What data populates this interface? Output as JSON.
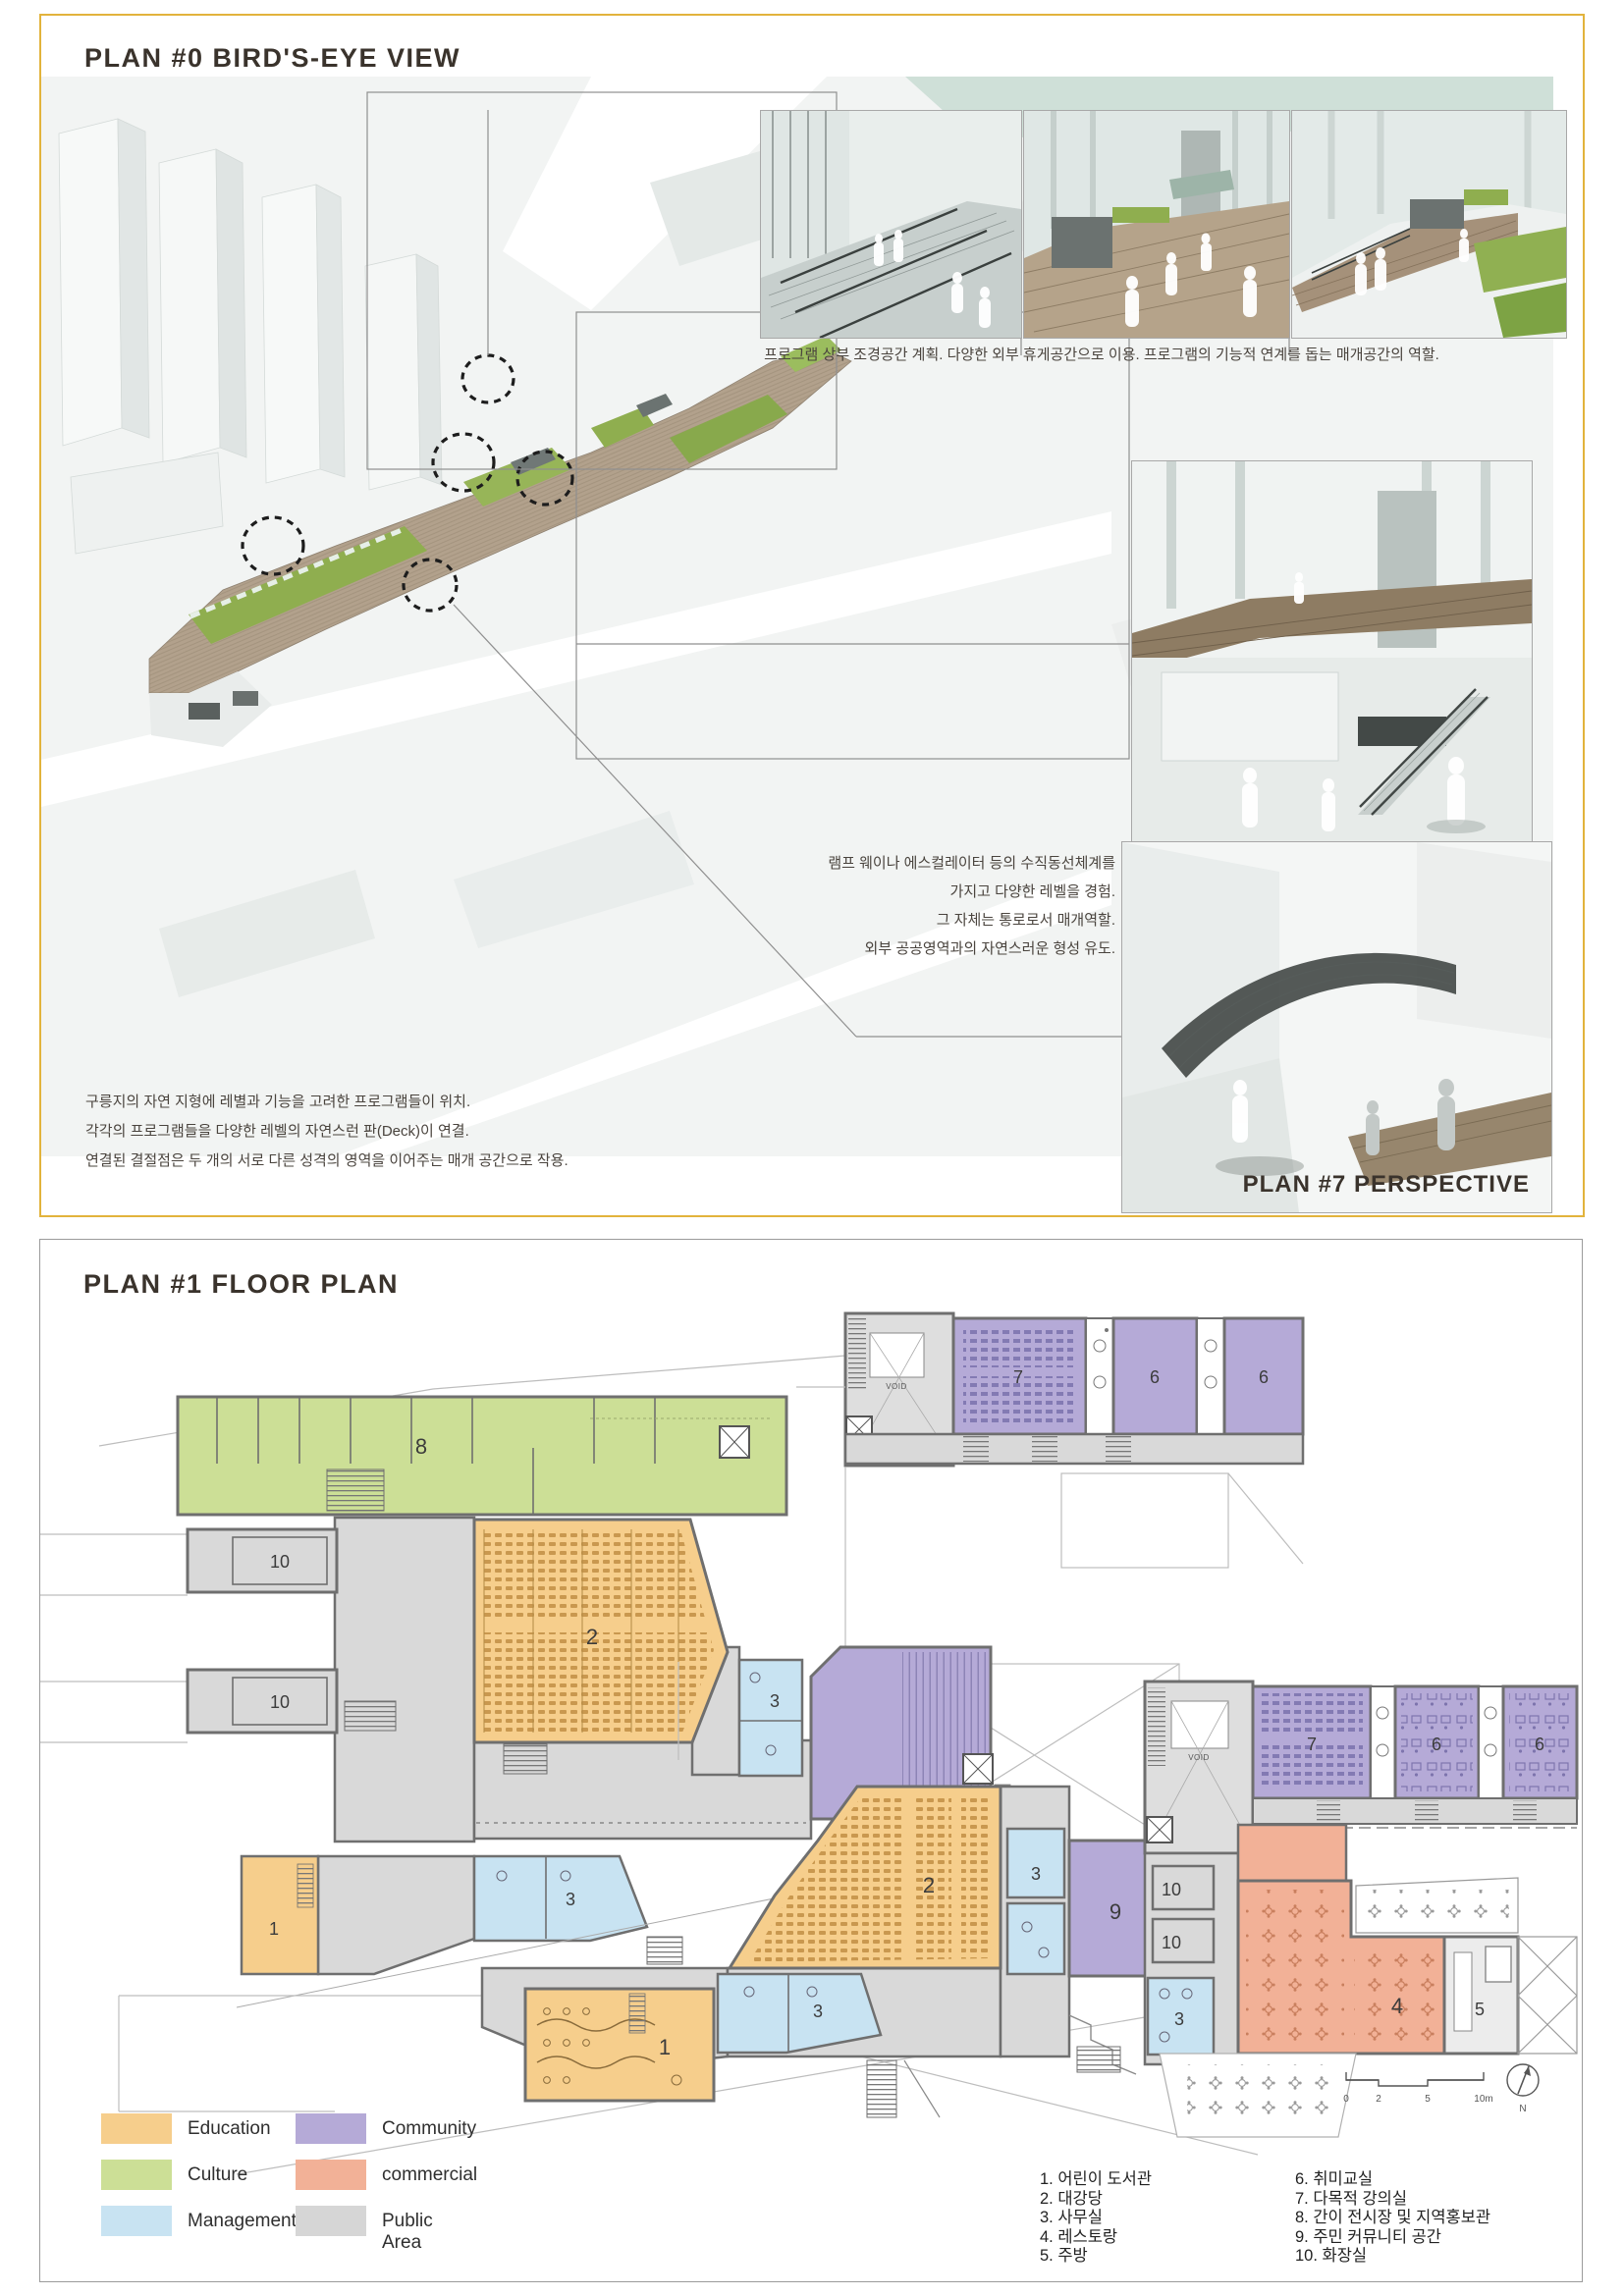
{
  "panel_top": {
    "title": "PLAN #0 BIRD'S-EYE VIEW",
    "insets_caption": "프로그램 상부 조경공간 계획. 다양한 외부 휴게공간으로 이용. 프로그램의 기능적 연계를 돕는 매개공간의 역할.",
    "annotation_vertical": {
      "line1": "램프 웨이나 에스컬레이터 등의 수직동선체계를",
      "line2": "가지고 다양한 레벨을 경험.",
      "line3": "그 자체는 통로로서 매개역할.",
      "line4": "외부 공공영역과의 자연스러운 형성 유도."
    },
    "annotation_site": {
      "line1": "구릉지의 자연 지형에 레별과 기능을 고려한 프로그램들이 위치.",
      "line2": "각각의 프로그램들을 다양한 레벨의 자연스런 판(Deck)이 연결.",
      "line3": "연결된 결절점은 두 개의 서로 다른 성격의 영역을 이어주는 매개 공간으로 작용."
    },
    "perspective_label": "PLAN #7 PERSPECTIVE"
  },
  "panel_bottom": {
    "title": "PLAN #1 FLOOR PLAN",
    "legend": {
      "items": [
        {
          "label": "Education",
          "color": "#F6CE8C"
        },
        {
          "label": "Culture",
          "color": "#CCDF96"
        },
        {
          "label": "Management",
          "color": "#C8E3F2"
        },
        {
          "label": "Community",
          "color": "#B5AAD7"
        },
        {
          "label": "commercial",
          "color": "#F2B197"
        },
        {
          "label": "Public Area",
          "color": "#D6D6D6"
        }
      ]
    },
    "room_index": {
      "col1": [
        "1. 어린이 도서관",
        "2. 대강당",
        "3. 사무실",
        "4. 레스토랑",
        "5. 주방"
      ],
      "col2": [
        "6. 취미교실",
        "7. 다목적 강의실",
        "8. 간이 전시장 및 지역홍보관",
        "9. 주민 커뮤니티 공간",
        "10. 화장실"
      ]
    },
    "scale_bar": {
      "t0": "0",
      "t1": "2",
      "t2": "5",
      "t3": "10m",
      "north": "N"
    },
    "plans": {
      "upper": {
        "r8": "8",
        "r10a": "10",
        "r10b": "10",
        "r2": "2",
        "r3a": "3",
        "r1": "1",
        "r3b": "3",
        "r7": "7",
        "r6a": "6",
        "r6b": "6",
        "void": "VOID"
      },
      "lower": {
        "r2": "2",
        "r3a": "3",
        "r9": "9",
        "r1": "1",
        "r3b": "3",
        "r7": "7",
        "r6a": "6",
        "r6b": "6",
        "r10a": "10",
        "r10b": "10",
        "r3c": "3",
        "r4": "4",
        "r5": "5",
        "void": "VOID"
      }
    }
  }
}
